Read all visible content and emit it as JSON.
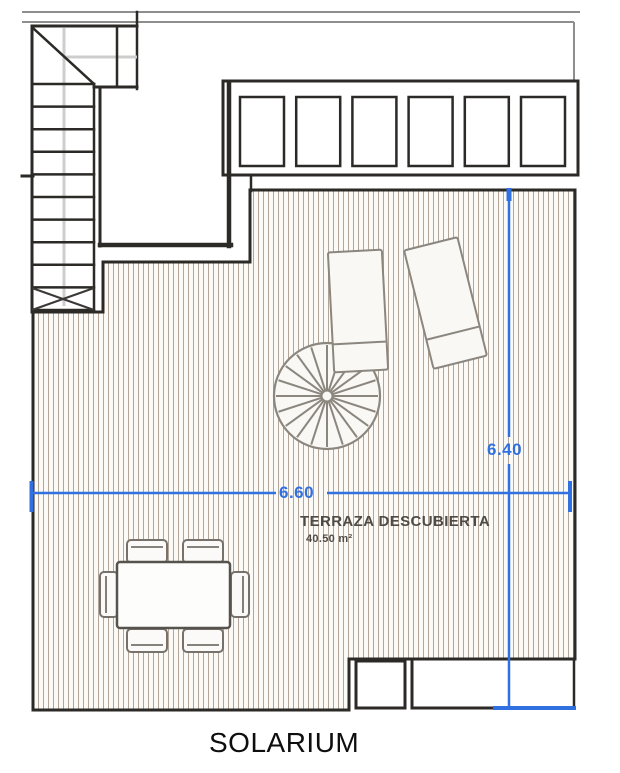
{
  "title": "SOLARIUM",
  "labels": {
    "area_name": "TERRAZA DESCUBIERTA",
    "area_size": "40.50 m²"
  },
  "dimensions": {
    "width_label": "6.60",
    "height_label": "6.40"
  },
  "colors": {
    "dimension_blue": "#3070e0",
    "wall_black": "#2b2a27",
    "decking_tan": "#b3a698",
    "furniture_gray": "#8b867e",
    "label_gray": "#4f4a44",
    "underlay_gray": "#8e8e8e"
  },
  "plan": {
    "stair": {
      "tread_count": 10
    },
    "pergola": {
      "panel_count": 6
    },
    "spiral_staircase": {
      "spoke_count": 20
    },
    "dining": {
      "chair_count": 6
    }
  }
}
